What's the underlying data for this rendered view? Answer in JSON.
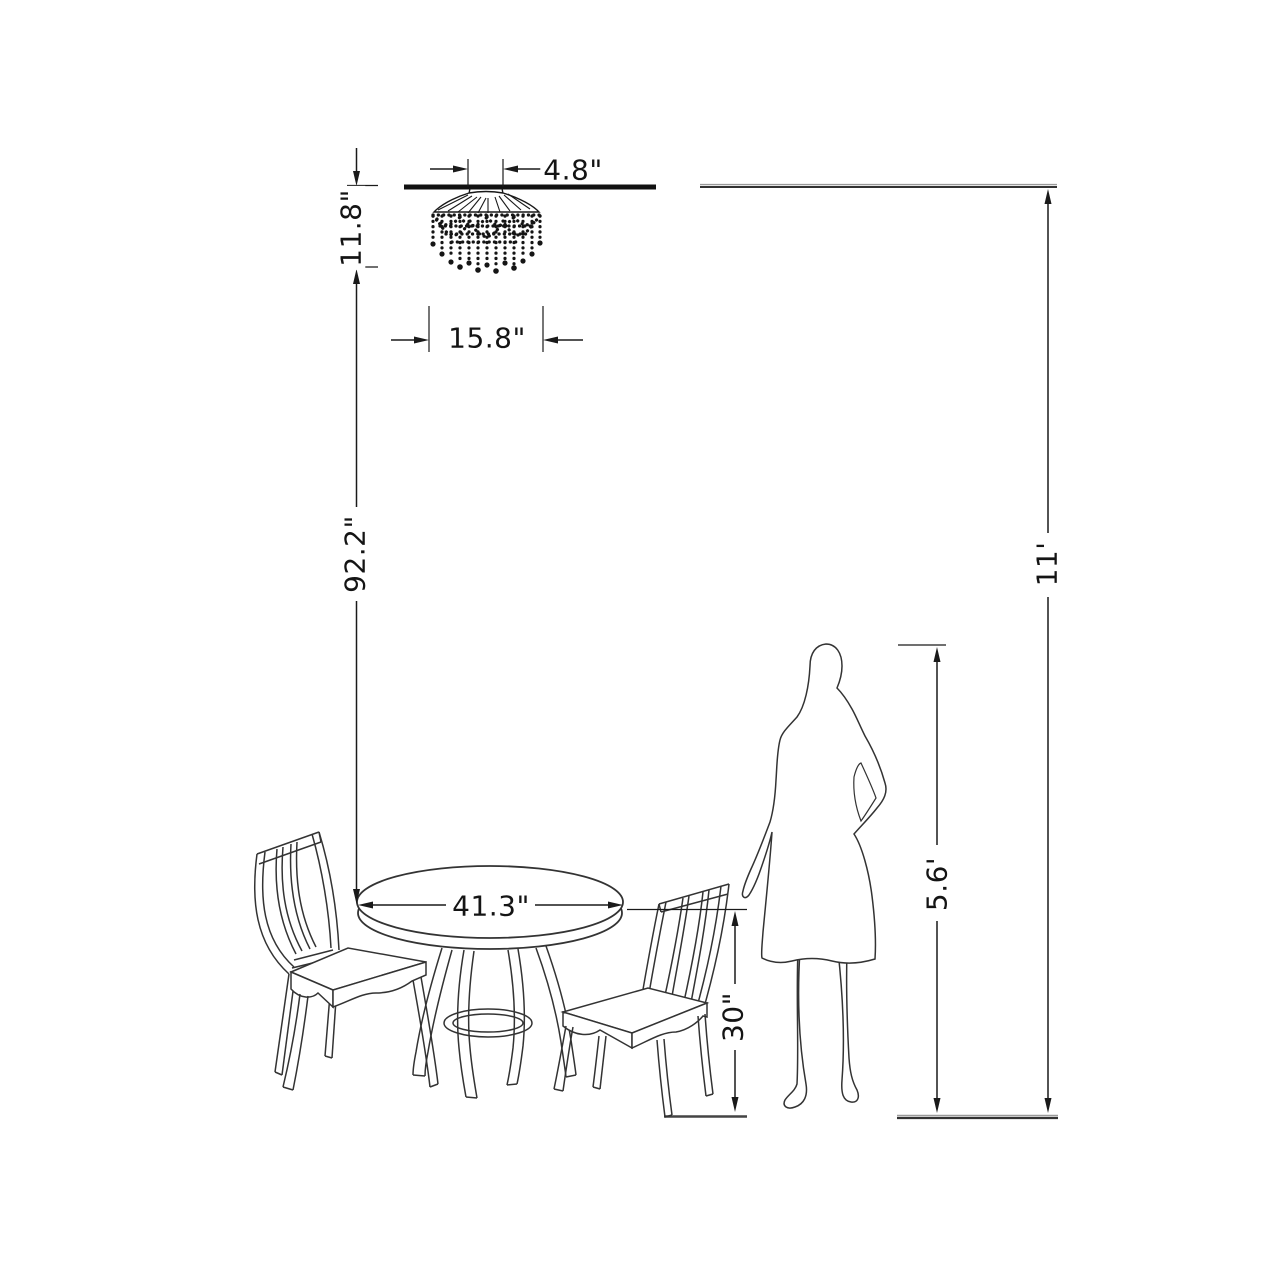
{
  "colors": {
    "dimension_line": "#1a1a1a",
    "drawing_line": "#333333",
    "background": "#ffffff"
  },
  "dimensions": {
    "canopy_width": "4.8\"",
    "chandelier_height": "11.8\"",
    "chandelier_width": "15.8\"",
    "chandelier_to_table": "92.2\"",
    "table_diameter": "41.3\"",
    "table_height": "30\"",
    "person_height": "5.6'",
    "ceiling_height": "11'"
  },
  "drawings": {
    "chandelier": "crystal-chandelier-drawing",
    "table": "round-pedestal-table-drawing",
    "left_chair": "slat-back-chair-drawing",
    "right_chair": "slat-back-chair-drawing",
    "person": "woman-silhouette-drawing",
    "ceiling": "ceiling-line",
    "floor": "floor-line"
  }
}
